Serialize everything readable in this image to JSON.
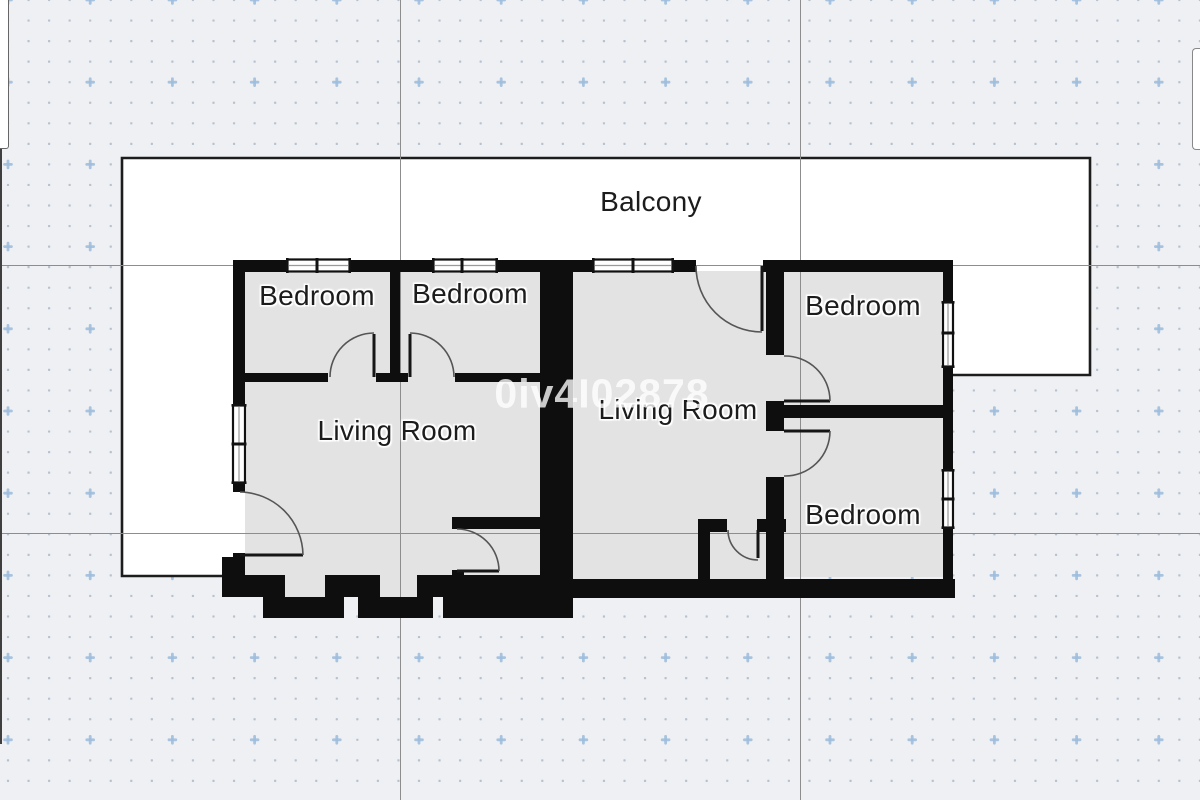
{
  "watermark": {
    "text": "0iv4I02878"
  },
  "rooms": {
    "balcony": {
      "label": "Balcony"
    },
    "bedroom_top_left": {
      "label": "Bedroom"
    },
    "bedroom_top_middle": {
      "label": "Bedroom"
    },
    "living_room_left": {
      "label": "Living Room"
    },
    "living_room_middle": {
      "label": "Living Room"
    },
    "bedroom_top_right": {
      "label": "Bedroom"
    },
    "bedroom_bottom_right": {
      "label": "Bedroom"
    }
  },
  "grid": {
    "background": "#eef0f3",
    "dot_color": "#a9b7c8",
    "plus_color": "#9fbedd",
    "line_color": "#8d8d8d",
    "dot_spacing": 20.55,
    "plus_every": 4
  },
  "plan": {
    "wall_color": "#0e0e0e",
    "floor_color": "#e3e3e3",
    "balcony_fill": "#ffffff",
    "outline_color": "#1d1d1d",
    "door_arc_color": "#555555",
    "window_frame_color": "#111111"
  }
}
